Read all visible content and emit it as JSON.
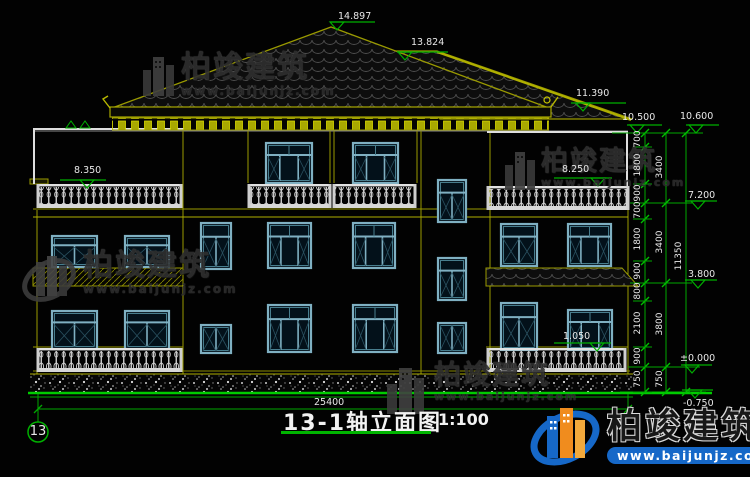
{
  "drawing": {
    "title": "13-1轴立面图",
    "scale": "1:100",
    "axis_bubble": "13",
    "total_width_dim": "25400",
    "levels": {
      "ridge_main": "14.897",
      "ridge_secondary": "13.824",
      "eave": "11.390",
      "parapet_left": "10.500",
      "parapet_right": "10.600",
      "terrace_left": "8.350",
      "terrace_right": "8.250",
      "floor3": "7.200",
      "floor2": "3.800",
      "railing_bottom": "1.050",
      "ground": "±0.000",
      "site": "-0.750"
    },
    "right_chain_segments": [
      "700",
      "1800",
      "900",
      "700",
      "1800",
      "900",
      "800",
      "2100",
      "900",
      "750"
    ],
    "right_chain_floors": [
      "3400",
      "3400",
      "3800",
      "750"
    ],
    "right_chain_total": "11350"
  },
  "watermark": {
    "title": "柏竣建筑",
    "url": "www.baijunjz.com"
  },
  "logo": {
    "title": "柏竣建筑",
    "url": "www.baijunjz.com"
  },
  "colors": {
    "dimension_green": "#00b050",
    "structure_olive": "#9a9a00",
    "line_white": "#e0e0e0",
    "window_blue": "#7fb0c2",
    "logo_blue": "#1668c8",
    "logo_orange": "#f08c1e",
    "background": "#020202"
  }
}
